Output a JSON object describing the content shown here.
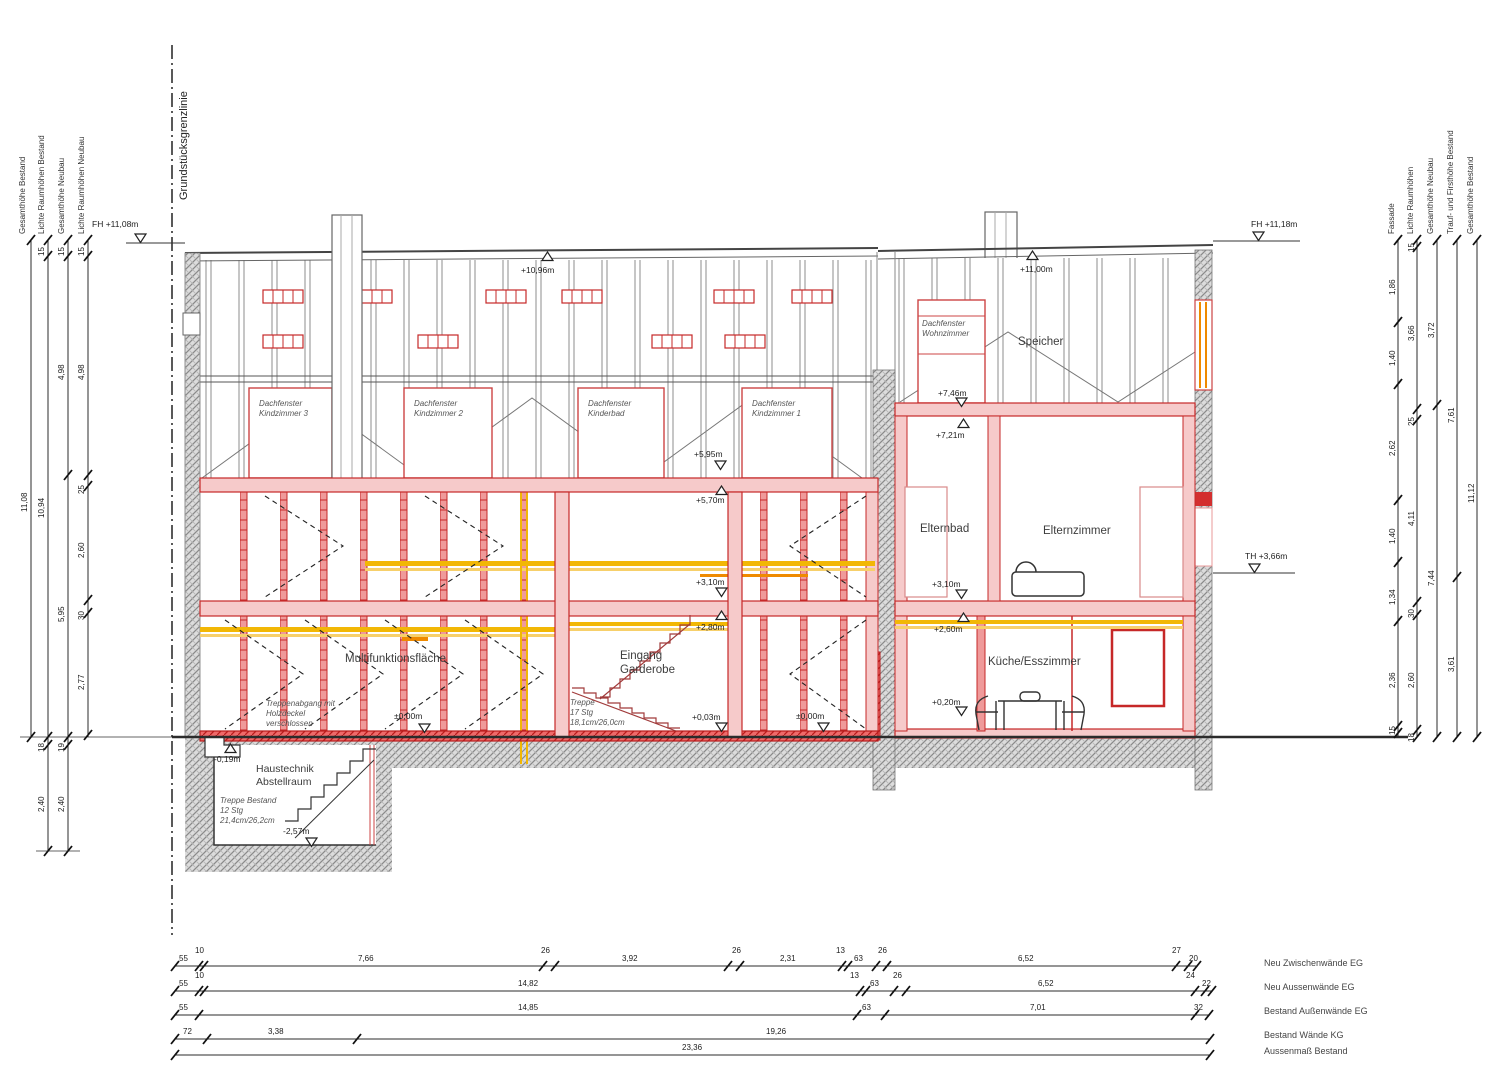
{
  "labels": {
    "property_line": "Grundstücksgrenzlinie",
    "left_axis": [
      "Gesamthöhe Bestand",
      "Lichte Raumhöhen Bestand",
      "Gesamthöhe Neubau",
      "Lichte Raumhöhen Neubau"
    ],
    "right_axis": [
      "Fassade",
      "Lichte Raumhöhen",
      "Gesamthöhe Neubau",
      "Trauf- und Firsthöhe Bestand",
      "Gesamthöhe Bestand"
    ]
  },
  "rooms": {
    "dachfenster_kind3": "Dachfenster\nKindzimmer 3",
    "dachfenster_kind2": "Dachfenster\nKindzimmer 2",
    "dachfenster_kinderbad": "Dachfenster\nKinderbad",
    "dachfenster_kind1": "Dachfenster\nKindzimmer 1",
    "dachfenster_wohnzimmer": "Dachfenster\nWohnzimmer",
    "speicher": "Speicher",
    "elternbad": "Elternbad",
    "elternzimmer": "Elternzimmer",
    "kueche": "Küche/Esszimmer",
    "multifunktion": "Multifunktionsfläche",
    "eingang": "Eingang\nGarderobe",
    "haustechnik": "Haustechnik\nAbstellraum"
  },
  "notes": {
    "treppe_neu": "Treppe\n17 Stg\n18,1cm/26,0cm",
    "treppe_bestand": "Treppe Bestand\n12 Stg\n21,4cm/26,2cm",
    "treppenabgang": "Treppenabgang mit\nHolzdeckel\nverschlossen"
  },
  "levels": {
    "fh_left": "FH +11,08m",
    "ridge_left": "+10,96m",
    "ridge_right": "+11,00m",
    "fh_right": "FH +11,18m",
    "th_right": "TH +3,66m",
    "speicher_floor": "+7,46m",
    "og_ceiling_right": "+7,21m",
    "attic_floor": "+5,95m",
    "og_ceiling_left": "+5,70m",
    "og_floor_left": "+3,10m",
    "eg_ceiling_left": "+2,80m",
    "eg_floor_entry": "+0,03m",
    "zero_left": "±0,00m",
    "zero_right": "±0,00m",
    "og_floor_right": "+3,10m",
    "eg_ceiling_right": "+2,60m",
    "eg_floor_right": "+0,20m",
    "basement_entry": "-0,19m",
    "basement_floor": "-2,57m"
  },
  "dims": {
    "left": {
      "c1": [
        "11,08"
      ],
      "c2": [
        "15",
        "10,94",
        "18",
        "2,40"
      ],
      "c3": [
        "15",
        "4,98",
        "5,95",
        "19",
        "2,40"
      ],
      "c4": [
        "15",
        "4,98",
        "25",
        "2,60",
        "30",
        "2,77"
      ]
    },
    "right": {
      "fassade": [
        "1,86",
        "1,40",
        "2,62",
        "1,40",
        "1,34",
        "2,36",
        "15"
      ],
      "lichte": [
        "15",
        "3,66",
        "25",
        "4,11",
        "30",
        "2,60",
        "18"
      ],
      "gesamt_neubau": [
        "3,72",
        "7,44"
      ],
      "trauf_first": [
        "7,61",
        "3,61"
      ],
      "gesamt_bestand": [
        "11,12"
      ]
    },
    "bottom": {
      "rows": [
        {
          "label": "Neu Zwischenwände EG",
          "values": [
            "55",
            "10",
            "7,66",
            "26",
            "3,92",
            "26",
            "2,31",
            "13",
            "63",
            "26",
            "6,52",
            "27",
            "20"
          ]
        },
        {
          "label": "Neu Aussenwände EG",
          "values": [
            "55",
            "10",
            "14,82",
            "13",
            "63",
            "26",
            "6,52",
            "24",
            "22"
          ]
        },
        {
          "label": "Bestand Außenwände EG",
          "values": [
            "55",
            "14,85",
            "63",
            "7,01",
            "32"
          ]
        },
        {
          "label": "Bestand Wände KG",
          "values": [
            "72",
            "3,38",
            "19,26"
          ]
        },
        {
          "label": "Aussenmaß Bestand",
          "values": [
            "23,36"
          ]
        }
      ]
    }
  },
  "colors": {
    "wall_red": "#c62828",
    "wall_pink": "#f6caca",
    "post_fill": "#ef9a9a",
    "bright_red": "#e53935",
    "band_yellow": "#f2b705",
    "band_orange": "#ef8a00",
    "hatch_gray": "#8a8a8a",
    "line_dark": "#2b2b2b"
  }
}
